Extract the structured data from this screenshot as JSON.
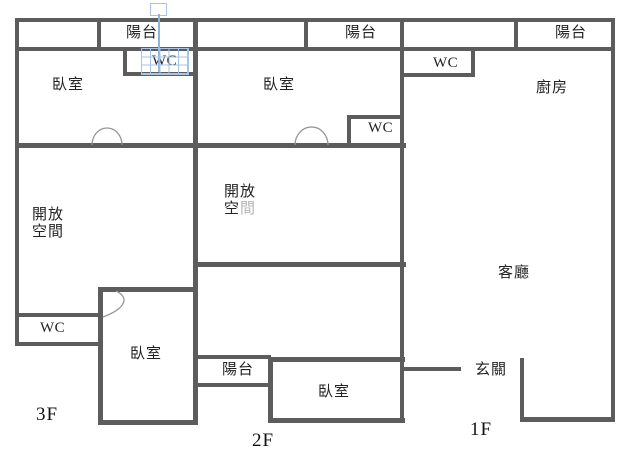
{
  "colors": {
    "wall": "#5c5c5c",
    "text": "#222222",
    "dim_text": "#b5b5b5",
    "arc_line": "#959595",
    "overlay_blue": "#a6c4e4"
  },
  "floors": [
    {
      "id": "3f",
      "label": "3F",
      "rooms": {
        "balcony": "陽台",
        "wc_top": "WC",
        "bedroom_top": "臥室",
        "open_line1": "開放",
        "open_line2": "空間",
        "wc_bottom": "WC",
        "bedroom_bottom": "臥室"
      }
    },
    {
      "id": "2f",
      "label": "2F",
      "rooms": {
        "balcony": "陽台",
        "bedroom_top": "臥室",
        "wc": "WC",
        "open_line1": "開放",
        "open_line2_dark": "空",
        "open_line2_dim": "間",
        "balcony_bottom": "陽台",
        "bedroom_bottom": "臥室"
      }
    },
    {
      "id": "1f",
      "label": "1F",
      "rooms": {
        "balcony": "陽台",
        "wc": "WC",
        "kitchen": "廚房",
        "living": "客廳",
        "entry": "玄關"
      }
    }
  ]
}
